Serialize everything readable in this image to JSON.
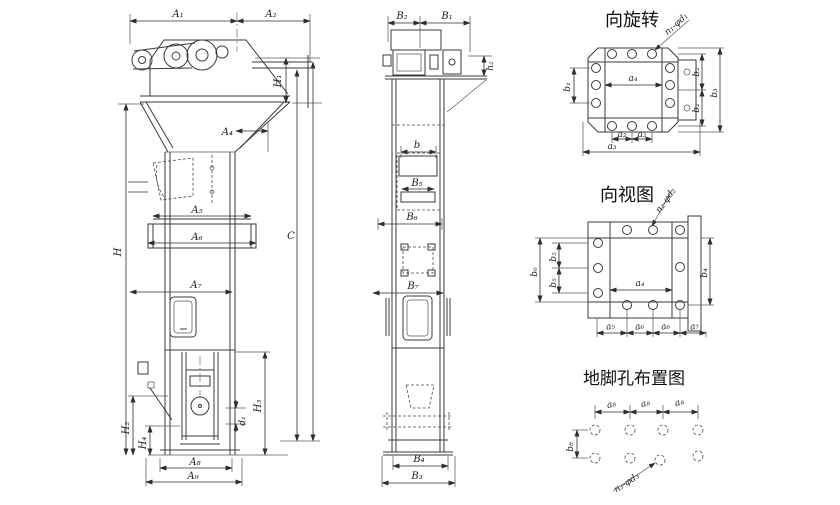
{
  "colors": {
    "line": "#3a3a3a",
    "text": "#1c1c1c",
    "background": "#ffffff"
  },
  "front_view": {
    "dims": {
      "a1": "A₁",
      "a2": "A₂",
      "a4": "A₄",
      "a5": "A₅",
      "a6": "A₆",
      "a7": "A₇",
      "a8": "A₈",
      "a9": "A₉",
      "h": "H",
      "h1": "H₁",
      "h2": "H₂",
      "h3": "H₃",
      "h4": "H₄",
      "c": "C",
      "d1": "d₁"
    }
  },
  "side_view": {
    "dims": {
      "b1": "B₁",
      "b2": "B₂",
      "b3": "B₃",
      "b4": "B₄",
      "b5": "B₅",
      "b6": "B₆",
      "b7": "B₇",
      "b": "b",
      "h2": "h₂"
    }
  },
  "rotation_view": {
    "title": "向旋转",
    "leader": "n₁-φd₁",
    "dims": {
      "a2a": "a₂",
      "a2b": "a₂",
      "a3": "a₃",
      "a4": "a₄",
      "b1": "b₁",
      "b2a": "b₂",
      "b2b": "b₂",
      "b3": "b₃"
    }
  },
  "direction_view": {
    "title": "向视图",
    "leader": "n₂-φd₂",
    "dims": {
      "a4": "a₄",
      "a5": "a₅",
      "a6a": "a₆",
      "a6b": "a₆",
      "a7": "a₇",
      "b4": "b₄",
      "b5a": "b₅",
      "b5b": "b₅",
      "b6": "b₆"
    }
  },
  "anchor_view": {
    "title": "地脚孔布置图",
    "leader": "n₃-φd₃",
    "dims": {
      "a8a": "a₈",
      "a8b": "a₈",
      "a8c": "a₈",
      "b8": "b₈"
    }
  }
}
